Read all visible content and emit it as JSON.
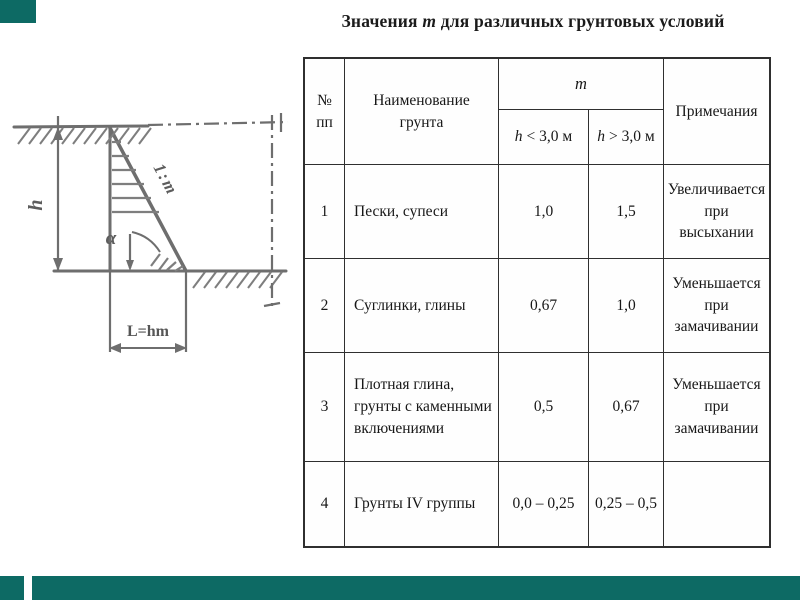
{
  "slide": {
    "background_color": "#ffffff",
    "accent_color": "#0d6a64"
  },
  "title": {
    "prefix": "Значения",
    "m_symbol": "m",
    "suffix": "для различных грунтовых условий"
  },
  "diagram": {
    "stroke_color": "#6e6e6e",
    "labels": {
      "height": "h",
      "slope_ratio": "1:m",
      "angle": "α",
      "base_length": "L=hm"
    }
  },
  "table": {
    "header": {
      "num": "№\nпп",
      "name": "Наименование\nгрунта",
      "m": "m",
      "sub_low": {
        "h": "h",
        "cond": "< 3,0 м"
      },
      "sub_high": {
        "h": "h",
        "cond": "> 3,0 м"
      },
      "notes": "Примечания"
    },
    "rows": [
      {
        "num": "1",
        "name": "Пески, супеси",
        "m_low": "1,0",
        "m_high": "1,5",
        "note": "Увеличивается\nпри высыхании"
      },
      {
        "num": "2",
        "name": "Суглинки,  глины",
        "m_low": "0,67",
        "m_high": "1,0",
        "note": "Уменьшается\nпри замачивании"
      },
      {
        "num": "3",
        "name": "Плотная глина,\nгрунты с каменными\nвключениями",
        "m_low": "0,5",
        "m_high": "0,67",
        "note": "Уменьшается\nпри замачивании"
      },
      {
        "num": "4",
        "name": "Грунты IV группы",
        "m_low": "0,0 – 0,25",
        "m_high": "0,25 – 0,5",
        "note": ""
      }
    ]
  }
}
